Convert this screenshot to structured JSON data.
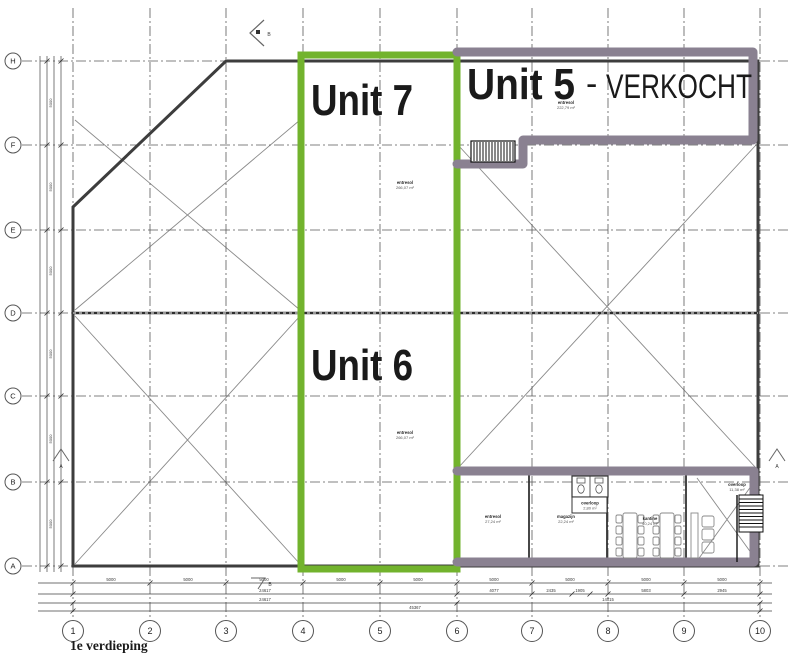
{
  "drawing": {
    "title": "1e verdieping",
    "units": {
      "unit7": {
        "name": "Unit 7",
        "area_name": "entresol",
        "area": "266,07 m²"
      },
      "unit6": {
        "name": "Unit 6",
        "area_name": "entresol",
        "area": "266,07 m²"
      },
      "unit5": {
        "name": "Unit 5",
        "sep": "-",
        "status": "VERKOCHT",
        "area_name": "entresol",
        "area": "222,79 m²"
      }
    },
    "rooms": {
      "entresol_small": {
        "name": "entresol",
        "area": "27,24 m²"
      },
      "magazijn": {
        "name": "magazijn",
        "area": "22,24 m²"
      },
      "kantine": {
        "name": "kantine",
        "area": "40,24 m²"
      },
      "overloop_wc": {
        "name": "overloop",
        "area": "2,80 m²"
      },
      "overloop_stairs": {
        "name": "overloop",
        "area": "11,38 m²"
      }
    },
    "grid": {
      "cols": [
        "1",
        "2",
        "3",
        "4",
        "5",
        "6",
        "7",
        "8",
        "9",
        "10"
      ],
      "rows": [
        "H",
        "F",
        "E",
        "D",
        "C",
        "B",
        "A"
      ]
    },
    "sections": {
      "a": "A",
      "b": "B"
    },
    "dims": {
      "bay": "5000",
      "left_total": "24617",
      "left_total2": "24617",
      "right_sub": [
        "4077",
        "2435",
        "1905",
        "5803",
        "2945"
      ],
      "right_total": "14015",
      "overall": "45367"
    },
    "colors": {
      "available": "#72b32d",
      "sold": "#8a8191"
    }
  }
}
